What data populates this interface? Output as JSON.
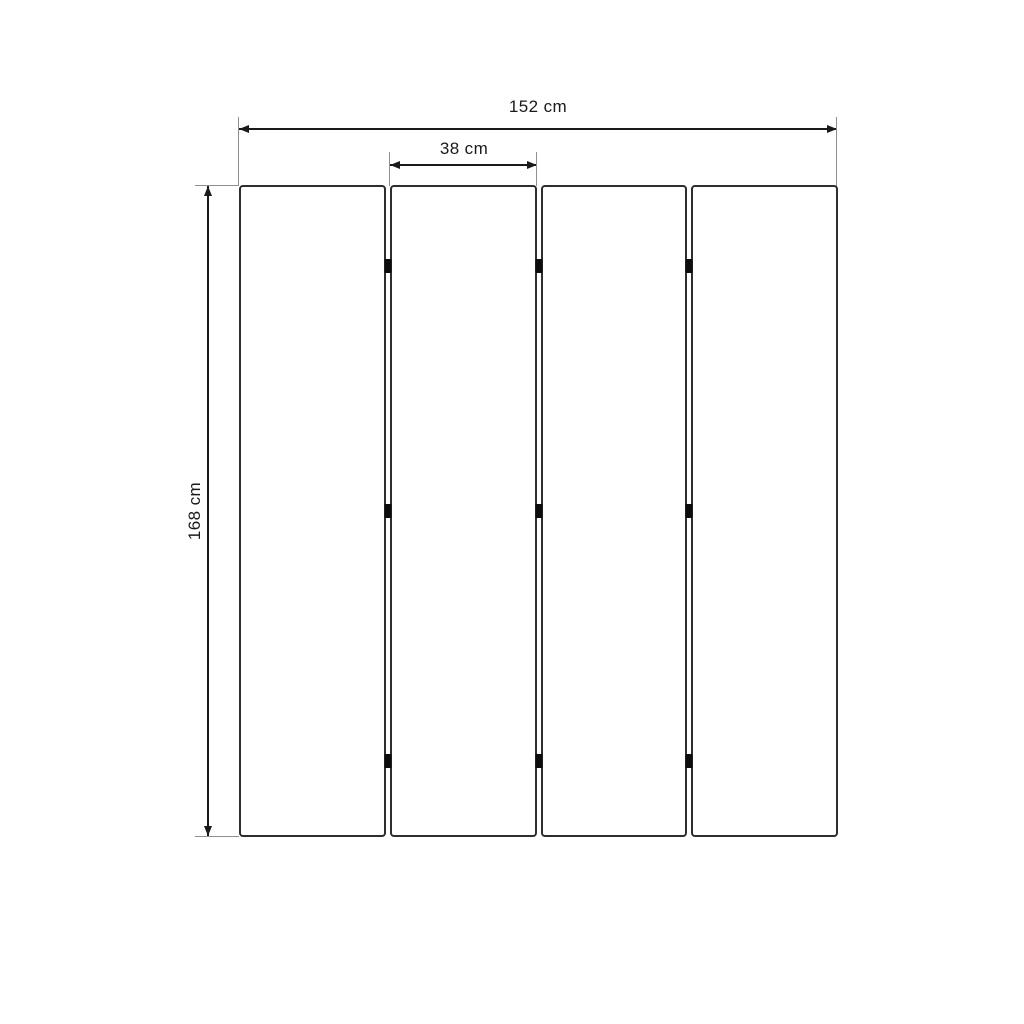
{
  "drawing": {
    "subject": "folding-screen-four-panels",
    "dimensions": {
      "total_width": {
        "value": 152,
        "unit": "cm",
        "label": "152 cm"
      },
      "panel_width": {
        "value": 38,
        "unit": "cm",
        "label": "38 cm"
      },
      "height": {
        "value": 168,
        "unit": "cm",
        "label": "168 cm"
      }
    },
    "panels": {
      "count": 4,
      "gap_px": 4,
      "hinge_rows": 3,
      "hinge_row_fractions": [
        0.124,
        0.5,
        0.883
      ]
    },
    "colors": {
      "line": "#1a1a1a",
      "extension": "#8f8f8f",
      "panel_border": "#2e2e2e",
      "hinge": "#0d0d0d",
      "background": "#ffffff",
      "text": "#1a1a1a"
    }
  }
}
